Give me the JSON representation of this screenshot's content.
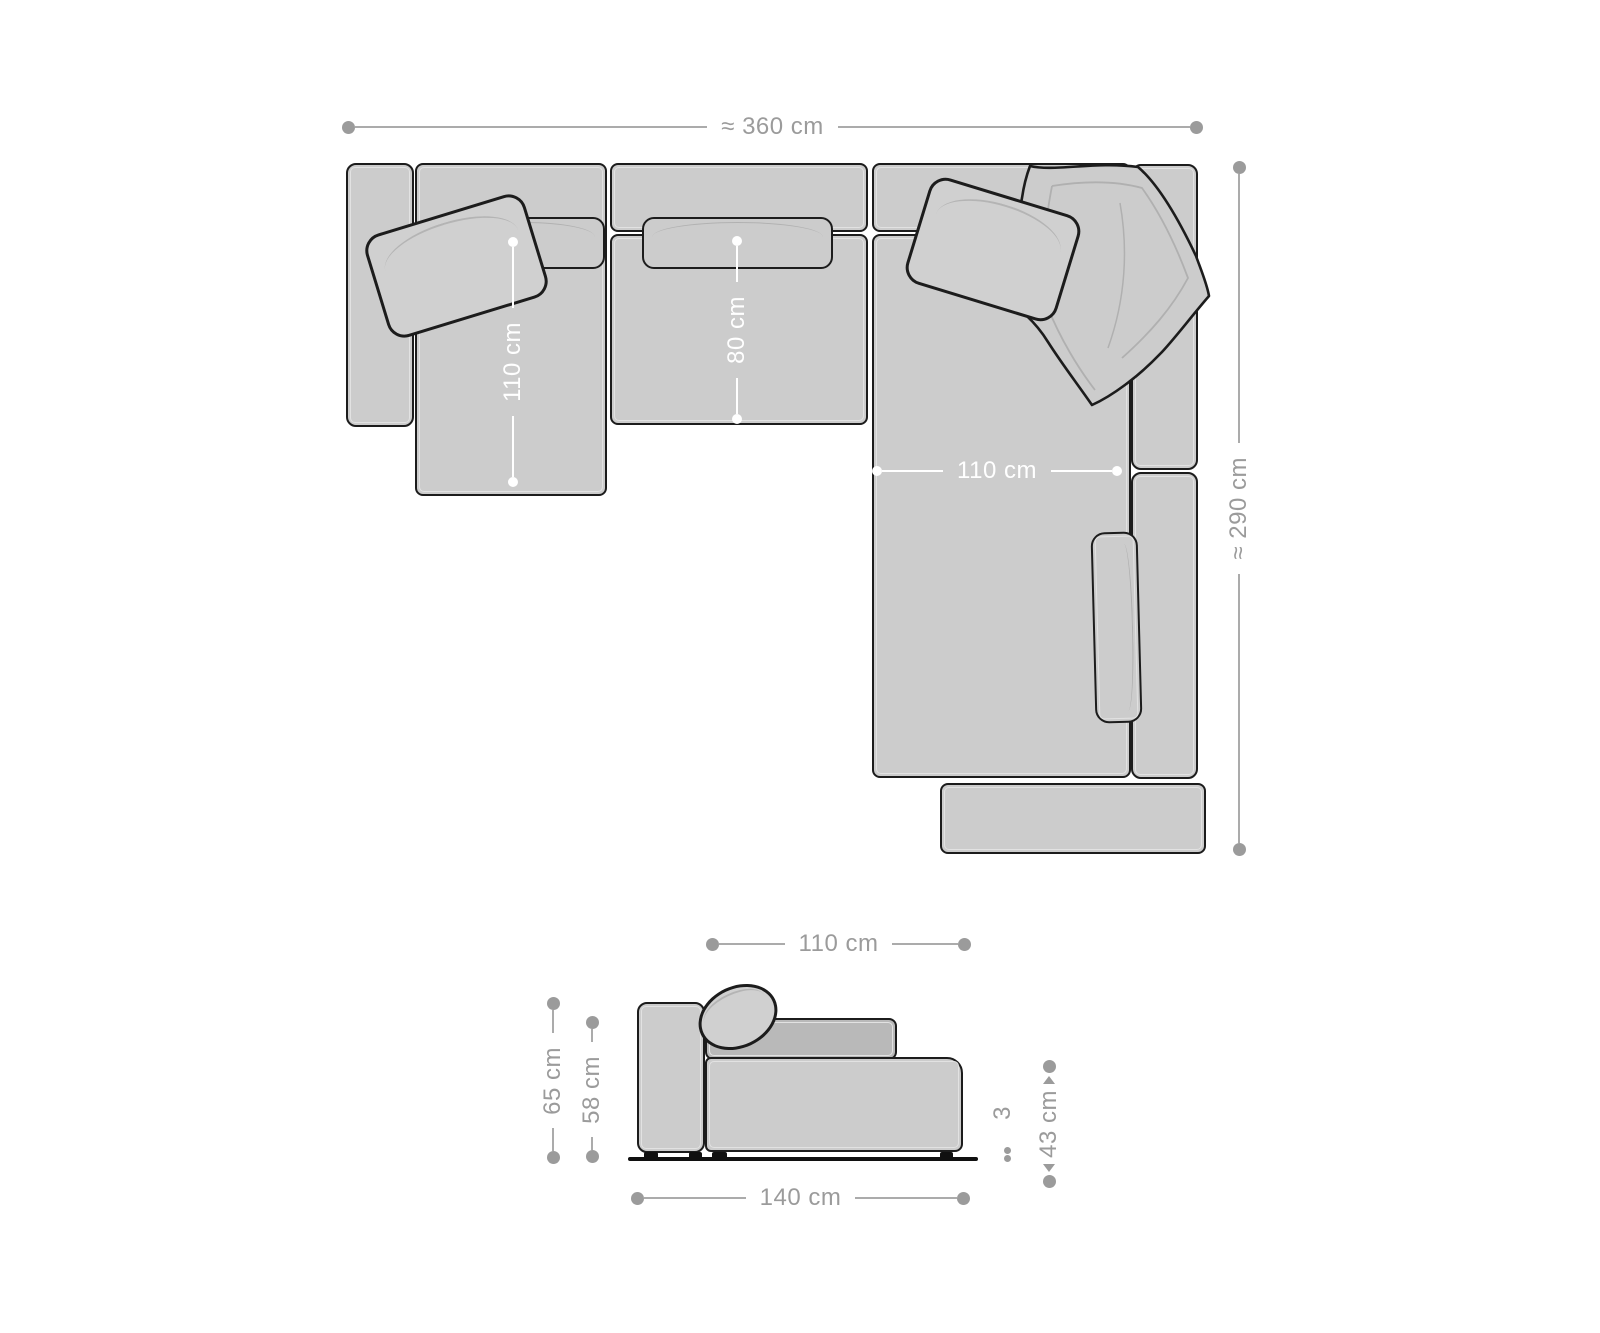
{
  "top_view": {
    "overall_width": {
      "label": "≈ 360 cm"
    },
    "overall_depth": {
      "label": "≈ 290 cm"
    },
    "chaise_depth": {
      "label": "110 cm"
    },
    "middle_seat_depth": {
      "label": "80 cm"
    },
    "right_seat_width": {
      "label": "110 cm"
    }
  },
  "side_view": {
    "seat_width": {
      "label": "110 cm"
    },
    "total_height": {
      "label": "65 cm"
    },
    "back_cushion_height": {
      "label": "58 cm"
    },
    "seat_height": {
      "label": "43 cm"
    },
    "leg_height": {
      "label": "3"
    },
    "total_depth": {
      "label": "140 cm"
    }
  },
  "colors": {
    "fabric": "#cccccc",
    "fabric_dark": "#b9b9b9",
    "outline": "#1c1c1c",
    "dimension_gray": "#9b9b9b",
    "dimension_white": "#ffffff",
    "background": "#ffffff"
  }
}
